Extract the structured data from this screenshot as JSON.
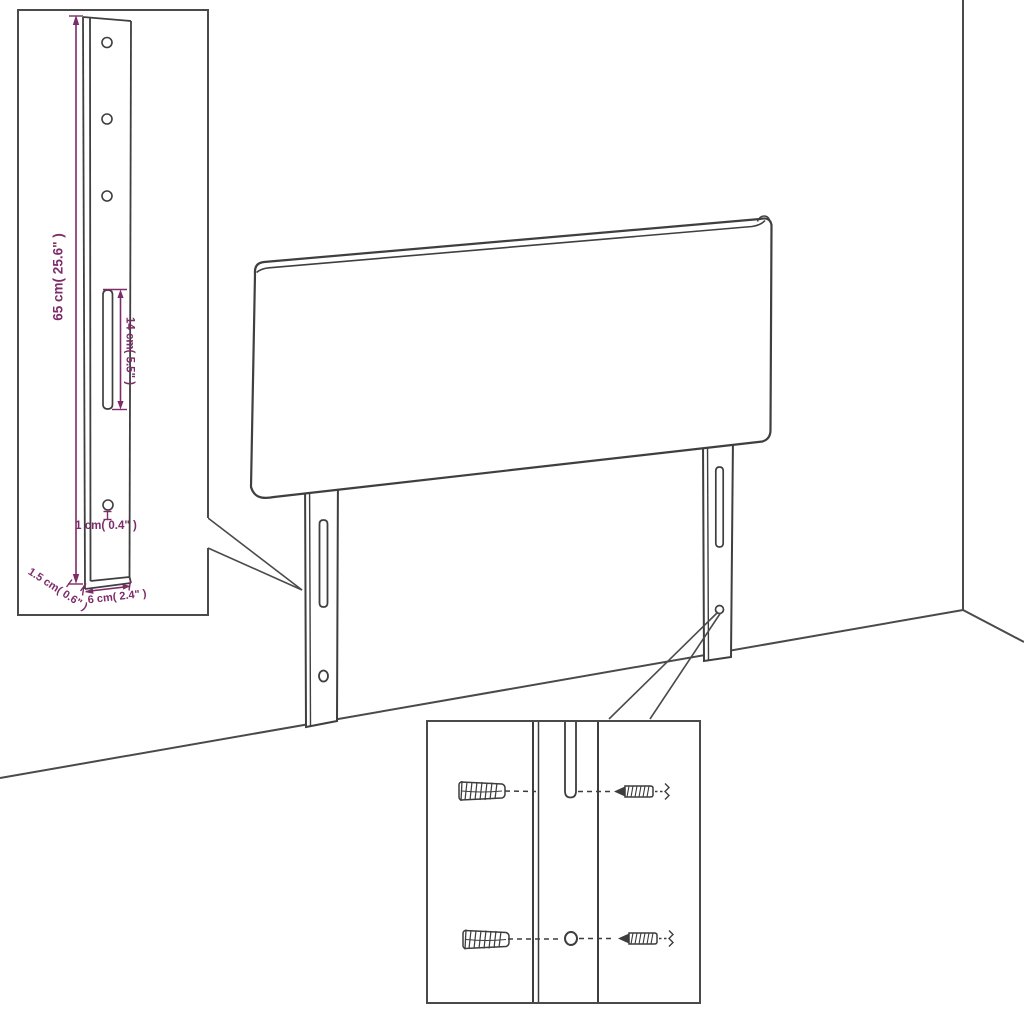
{
  "diagram": {
    "kind": "furniture-assembly-dimension-diagram",
    "subject": "upholstered headboard with two mounting legs, wall corner backdrop, detail insets",
    "colors": {
      "drawing_line": "#3f3f3f",
      "inset_border": "#4a4a4a",
      "dimension_accent": "#7d2b69",
      "background": "#ffffff"
    },
    "dimensions": {
      "height": "65 cm( 25.6\" )",
      "slot": "14 cm( 5.5\" )",
      "hole": "1 cm( 0.4\" )",
      "side_depth": "1.5 cm( 0.6\" )",
      "width": "6 cm( 2.4\" )"
    }
  }
}
